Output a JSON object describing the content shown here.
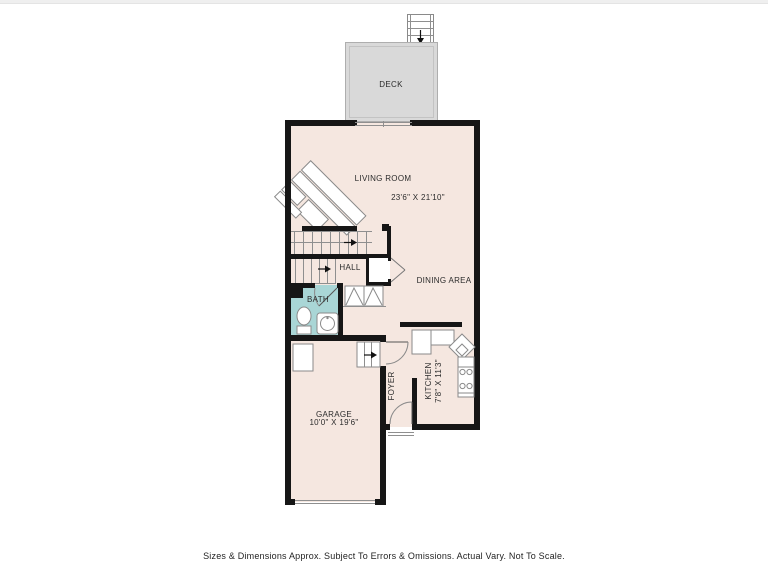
{
  "rooms": {
    "deck": {
      "label": "DECK"
    },
    "living_room": {
      "label": "LIVING ROOM",
      "dimensions": "23'6\" X 21'10\""
    },
    "dining_area": {
      "label": "DINING AREA"
    },
    "hall": {
      "label": "HALL"
    },
    "bath": {
      "label": "BATH"
    },
    "foyer": {
      "label": "FOYER"
    },
    "kitchen": {
      "label": "KITCHEN",
      "dimensions": "7'8\" X 11'3\""
    },
    "garage": {
      "label": "GARAGE",
      "dimensions": "10'0\" X 19'6\""
    }
  },
  "footer": {
    "disclaimer": "Sizes & Dimensions Approx. Subject To Errors & Omissions. Actual Vary. Not To Scale."
  },
  "colors": {
    "floor": "#f5e7e0",
    "deck": "#d9d9d9",
    "bath": "#a9d6d6",
    "wall": "#161616",
    "thin_line": "#8f8f8f"
  }
}
